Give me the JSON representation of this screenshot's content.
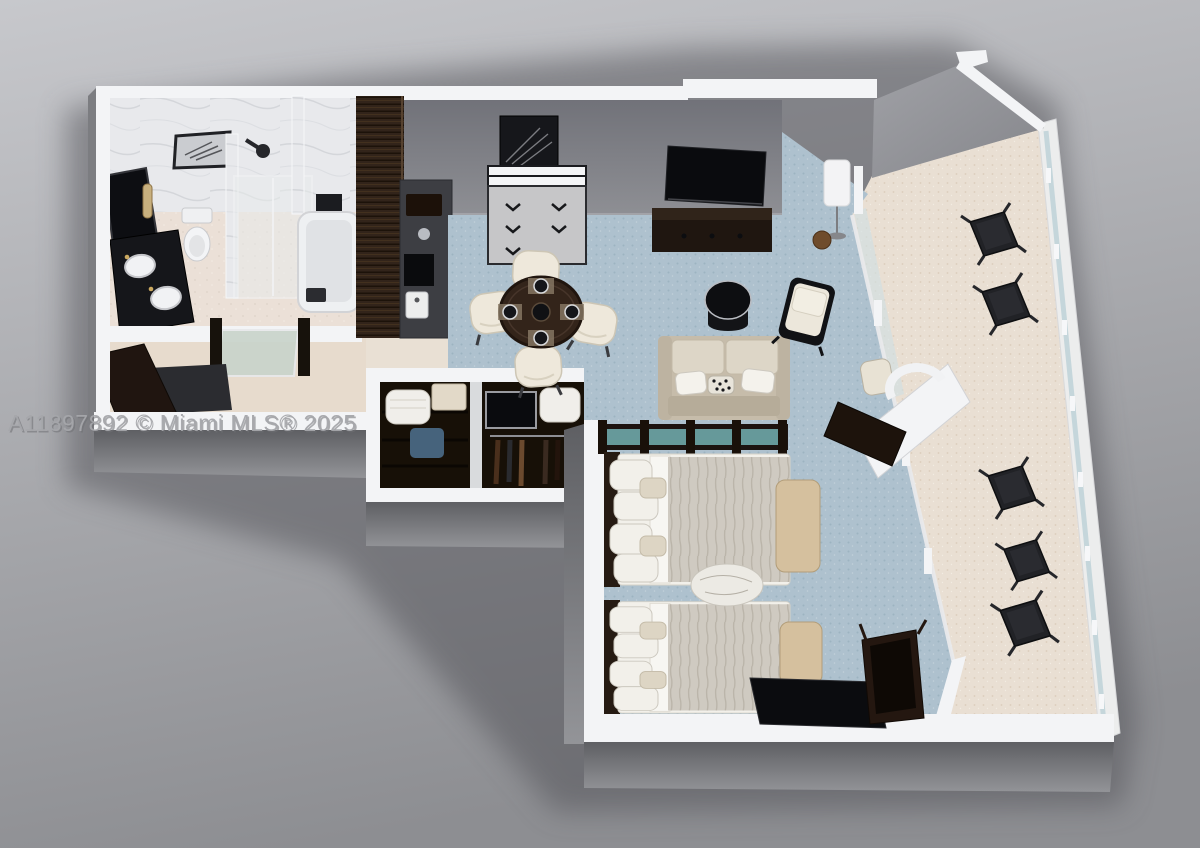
{
  "image": {
    "kind": "3d-floor-plan-rendering",
    "description": "Isometric 3D rendered floor plan of a hotel-style condo unit with bathroom, entry hall, living-dining room, double closet, bedroom with two beds, and a wrap-around glass-railed balcony"
  },
  "watermark": {
    "text": "A11897892 © Miami MLS® 2025"
  },
  "colors": {
    "bg_top": "#c7c8cc",
    "bg_bottom": "#8d8e92",
    "shadow": "#4f5054",
    "wall_white": "#f3f4f6",
    "wall_face_top": "#717279",
    "wall_face_bottom": "#8e8f94",
    "ext_top": "#5e5f63",
    "ext_bottom": "#939498",
    "angle_top": "#a0a1a6",
    "angle_bottom": "#85868b",
    "marble": "#e8e9ec",
    "bath_floor": "#ebe0d7",
    "entry_floor": "#e7dbcd",
    "carpet": "#aec1ce",
    "carpet_dot": "#9db3c1",
    "balcony_floor": "#e9dfd3",
    "balcony_dot": "#dbcdbc",
    "wood_dark": "#32241a",
    "counter": "#3d3e43",
    "black": "#111215",
    "sofa": "#c6bcaa",
    "cushion": "#ddd6c7",
    "bench": "#d5c09e",
    "blanket": "#cfcac1",
    "pillow": "#f2f0ea",
    "glass": "#cfe0e5",
    "teal": "#6fa8aa",
    "railing": "#eceded",
    "watermark": "#a6a7ab"
  },
  "scene": {
    "rooms": [
      "bathroom",
      "entry-hall",
      "living-dining-room",
      "closet-bay",
      "bedroom",
      "balcony"
    ],
    "bathroom_items": [
      "framed-artwork",
      "leaning-mirror",
      "double-sink-vanity",
      "toilet",
      "walk-in-shower",
      "towel-rack",
      "bathtub"
    ],
    "entry_items": [
      "entry-door",
      "door-mat",
      "console-table"
    ],
    "living_items": [
      "wardrobe",
      "bar-counter",
      "framed-artwork",
      "dresser",
      "wall-tv",
      "media-console",
      "floor-lamp",
      "plant-pot",
      "dining-table",
      "dining-chairs",
      "sofa",
      "coffee-table",
      "armchair"
    ],
    "closet_items": [
      "linen-shelves",
      "luggage-tv-niche",
      "hanging-clothes"
    ],
    "bedroom_items": [
      "glass-headboard-partition",
      "bed-1",
      "bed-2",
      "foot-bench-1",
      "foot-bench-2",
      "throw-blanket",
      "leaning-tv",
      "writing-desk"
    ],
    "balcony_items": [
      "glass-railing",
      "sliding-door-track",
      "outdoor-chairs",
      "outdoor-tables",
      "desk-nook-chair",
      "round-back-chair",
      "nook-desk"
    ]
  }
}
